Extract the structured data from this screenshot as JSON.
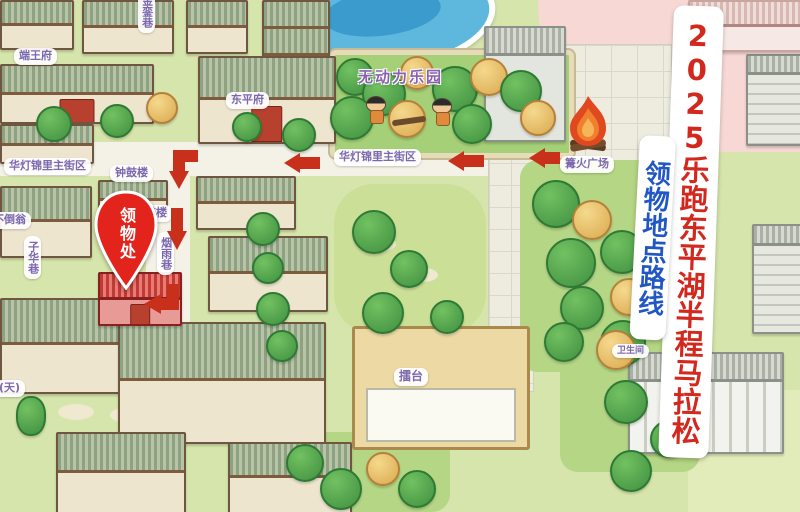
{
  "banners": {
    "title": {
      "text": "2025乐跑东平湖半程马拉松",
      "color": "#d3281e"
    },
    "subtitle": {
      "text": "领物地点路线",
      "color": "#2157c4"
    }
  },
  "pickup_pin": {
    "label": "领物处",
    "color": "#e3241d"
  },
  "place_labels": [
    {
      "id": "duan-wang-fu",
      "text": "端王府"
    },
    {
      "id": "jinluan-lane",
      "text": "金銮巷"
    },
    {
      "id": "dongping-fu",
      "text": "东平府"
    },
    {
      "id": "unpowered-park",
      "text": "无动力乐园"
    },
    {
      "id": "bonfire-plaza",
      "text": "篝火广场"
    },
    {
      "id": "huadeng-jinli-main-street-center",
      "text": "华灯锦里主街区"
    },
    {
      "id": "huadeng-jinli-main-street-left",
      "text": "华灯锦里主街区"
    },
    {
      "id": "bell-drum-tower",
      "text": "钟鼓楼"
    },
    {
      "id": "fan-lou",
      "text": "樊楼"
    },
    {
      "id": "yanyu-lane",
      "text": "烟雨巷"
    },
    {
      "id": "budaoweng",
      "text": "不倒翁"
    },
    {
      "id": "zihua-lane",
      "text": "子华巷"
    },
    {
      "id": "tian-partial",
      "text": "(天)"
    },
    {
      "id": "leitai-arena",
      "text": "擂台"
    },
    {
      "id": "restroom",
      "text": "卫生间"
    }
  ],
  "route": {
    "arrow_color": "#c9301c",
    "arrow_count": 6,
    "description": "红色箭头路线"
  },
  "palette": {
    "ground": "#d6e5ab",
    "pink_zone": "#f7d8d5",
    "pool_blue": "#5eb8dd",
    "label_purple": "#7b68ae",
    "arena_tan": "#ecd9a4",
    "grass": "#a5d077"
  }
}
